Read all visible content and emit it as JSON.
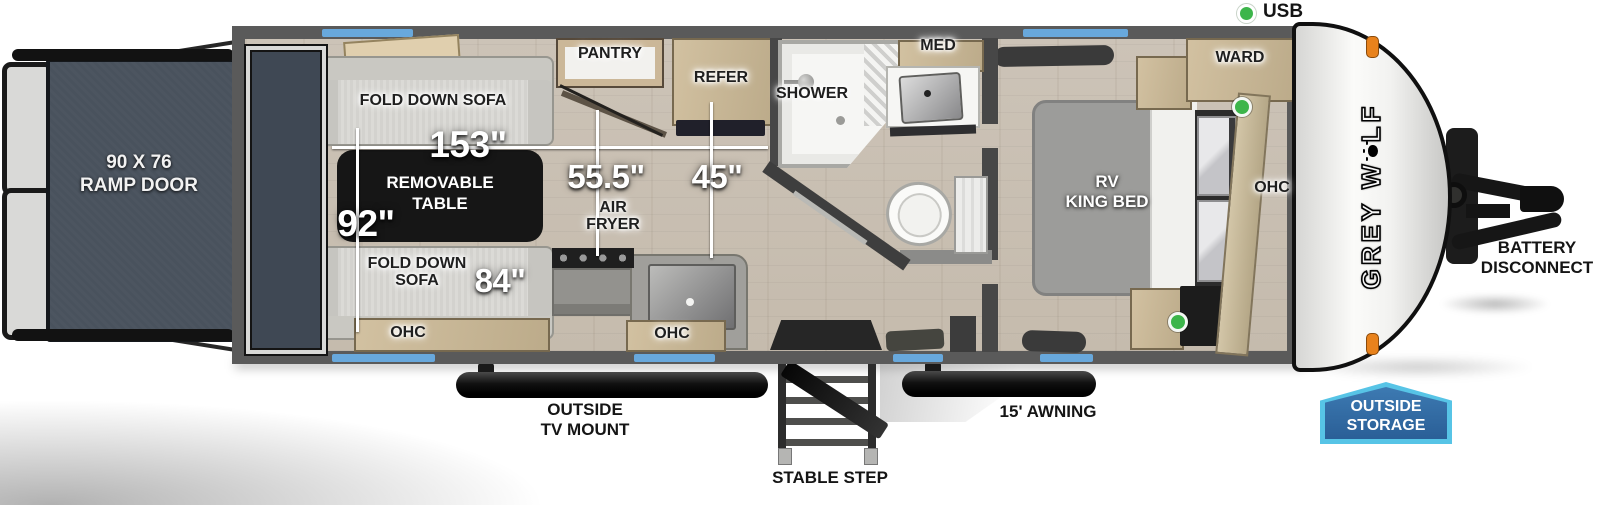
{
  "legend": {
    "usb": "USB"
  },
  "ramp": {
    "size_line1": "90 X 76",
    "size_line2": "RAMP DOOR"
  },
  "garage": {
    "sofa_top": "FOLD DOWN SOFA",
    "sofa_bottom_l1": "FOLD DOWN",
    "sofa_bottom_l2": "SOFA",
    "table_l1": "REMOVABLE",
    "table_l2": "TABLE",
    "ohc": "OHC"
  },
  "dims": {
    "garage_length": "153\"",
    "garage_width": "92\"",
    "kitchen_run": "55.5\"",
    "entry_run": "45\"",
    "sofa_length": "84\""
  },
  "kitchen": {
    "pantry": "PANTRY",
    "refer": "REFER",
    "air_fryer_l1": "AIR",
    "air_fryer_l2": "FRYER",
    "ohc": "OHC"
  },
  "bath": {
    "shower": "SHOWER",
    "med": "MED"
  },
  "bedroom": {
    "bed_l1": "RV",
    "bed_l2": "KING BED",
    "ward": "WARD",
    "ohc": "OHC"
  },
  "exterior": {
    "brand_l1": "GREY W",
    "brand_l2": "LF",
    "battery_l1": "BATTERY",
    "battery_l2": "DISCONNECT",
    "tv_l1": "OUTSIDE",
    "tv_l2": "TV MOUNT",
    "stable_step": "STABLE STEP",
    "awning": "15' AWNING",
    "storage_l1": "OUTSIDE",
    "storage_l2": "STORAGE"
  },
  "colors": {
    "window_marker": "#68a8dc",
    "usb_green": "#3cb54a",
    "marker_orange": "#e8821c",
    "storage_badge_fill": "#2d63a0",
    "storage_badge_border": "#57c4e6",
    "wall_gray": "#5a5a5a",
    "ramp_door": "#49525d",
    "wood_cabinet": "#c6b493",
    "table_black": "#161616"
  }
}
